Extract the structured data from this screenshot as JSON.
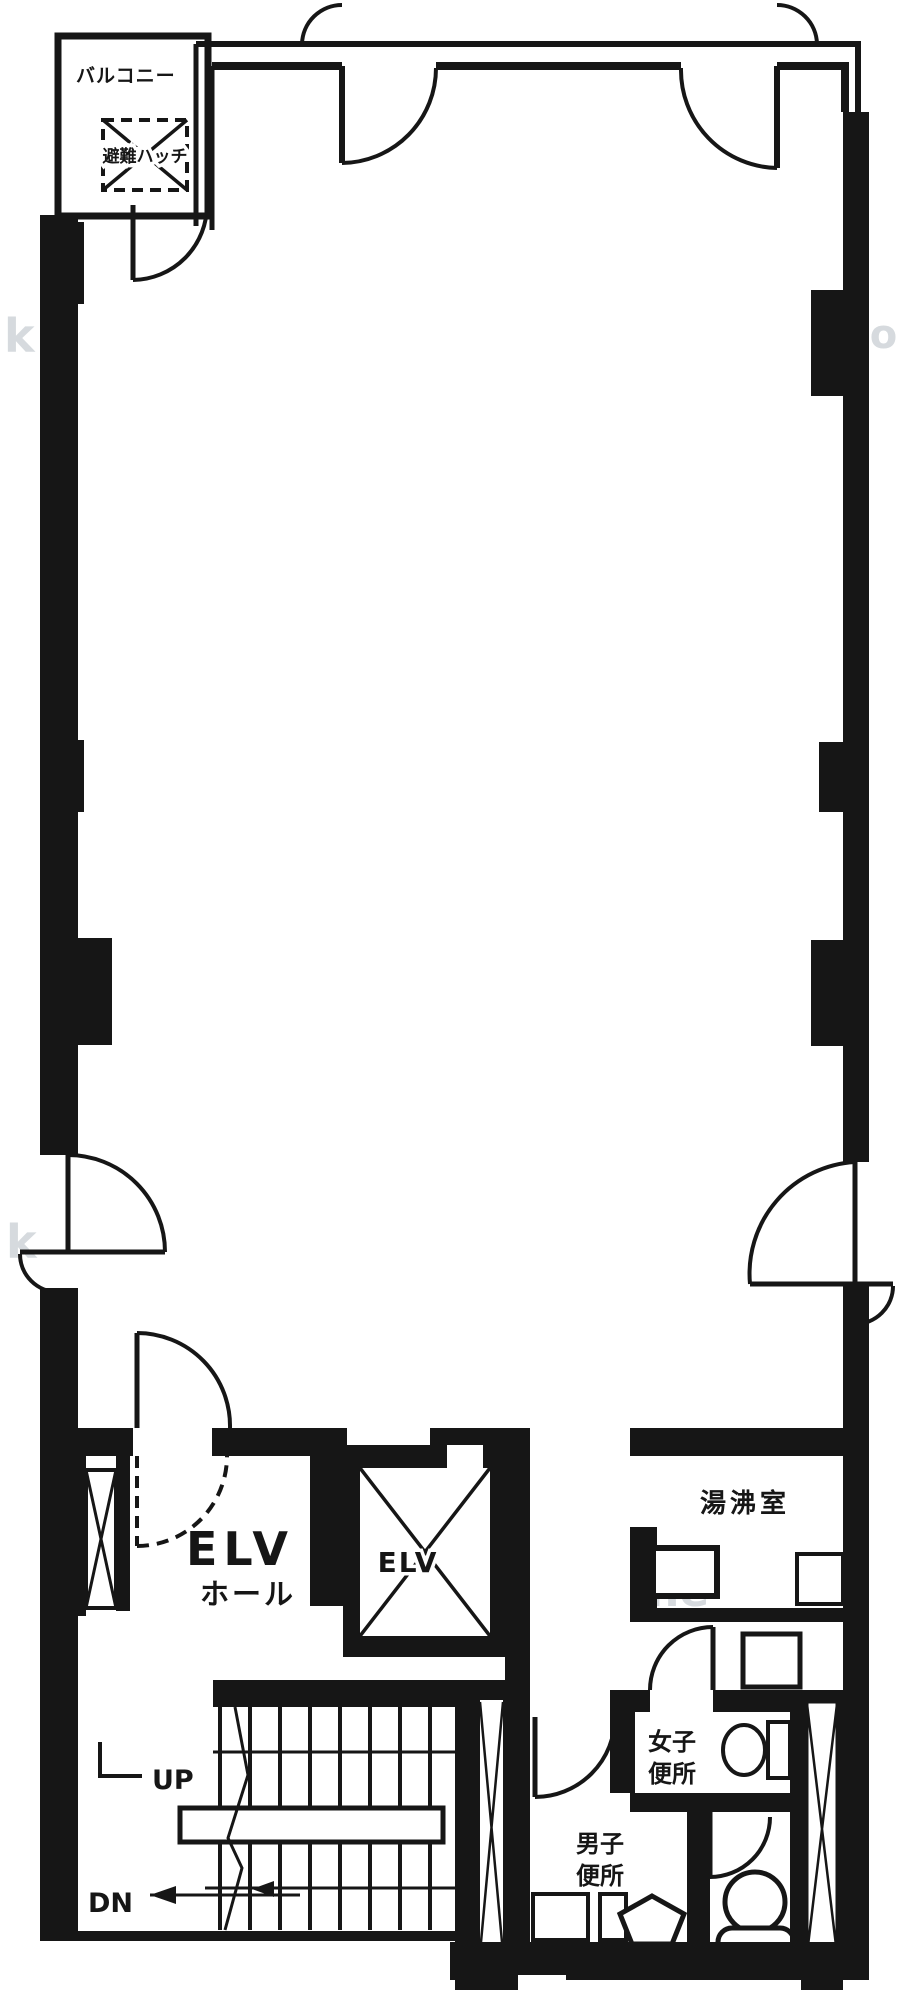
{
  "plan": {
    "type": "architectural-floor-plan",
    "labels": {
      "balcony": "バルコニー",
      "hatch": "避難ハッチ",
      "elv_hall_1": "ELV",
      "elv_hall_2": "ホール",
      "elv_shaft": "ELV",
      "kitchenette": "湯沸室",
      "women_1": "女子",
      "women_2": "便所",
      "men_1": "男子",
      "men_2": "便所",
      "up": "UP",
      "dn": "DN"
    },
    "watermarks": [
      "k",
      "io",
      "k",
      "ne",
      "fi"
    ],
    "colors": {
      "ink": "#161616",
      "paper": "#ffffff",
      "watermark": "#ccd2d6"
    }
  }
}
